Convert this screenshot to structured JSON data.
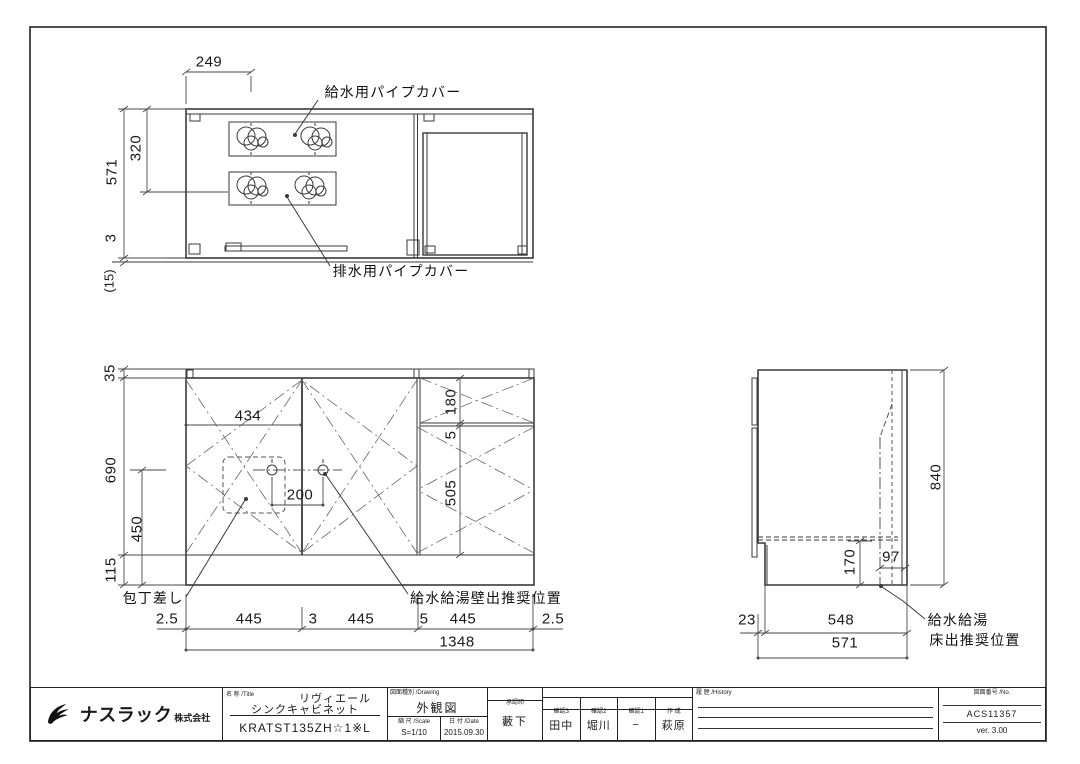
{
  "colors": {
    "line": "#3a3a3a",
    "dim": "#4a4a4a",
    "text": "#1a1a1a",
    "background": "#ffffff"
  },
  "plan_view": {
    "label_supply_pipe_cover": "給水用パイプカバー",
    "label_drain_pipe_cover": "排水用パイプカバー",
    "dim_top_width": "249",
    "dim_depth_total": "571",
    "dim_depth_inner": "320",
    "dim_back_gap": "3",
    "dim_wall_gap": "(15)"
  },
  "front_view": {
    "label_knife_holder": "包丁差し",
    "label_wall_outlet": "給水給湯壁出推奨位置",
    "dim_counter_height": "35",
    "dim_body_height": "690",
    "dim_inner_height": "450",
    "dim_toe_height": "115",
    "dim_left_span": "434",
    "dim_faucet_span": "200",
    "dim_drawer_height": "180",
    "dim_gap": "5",
    "dim_door_height": "505",
    "dim_bottom_row": [
      "2.5",
      "445",
      "3",
      "445",
      "5",
      "445",
      "2.5"
    ],
    "dim_total_width": "1348"
  },
  "side_view": {
    "label_floor_outlet_line1": "給水給湯",
    "label_floor_outlet_line2": "床出推奨位置",
    "dim_total_height": "840",
    "dim_bottom_space": "170",
    "dim_pipe_offset": "97",
    "dim_toe_inset": "23",
    "dim_depth_inner": "548",
    "dim_depth_total": "571"
  },
  "title_block": {
    "company": {
      "name": "ナスラック",
      "suffix": "株式会社"
    },
    "title_cell": {
      "header": "名 称 /Title",
      "product_line1": "リヴィエール",
      "product_line2": "シンクキャビネット",
      "model": "KRATST135ZH☆1※L"
    },
    "drawing_cell": {
      "header": "図面種別 /Drawing",
      "type": "外観図",
      "scale_header": "縮 尺 /Scale",
      "scale": "S=1/10",
      "date_header": "日 付 /Date",
      "date": "2015.09.30"
    },
    "approver_cell": {
      "header": "承認印",
      "name": "藪下"
    },
    "checkup_cell": {
      "header": "照合者 /Check up by ナスラック総合工場",
      "columns": [
        {
          "label": "確認3",
          "value": "田中"
        },
        {
          "label": "確認2",
          "value": "堀川"
        },
        {
          "label": "確認1",
          "value": "−"
        },
        {
          "label": "作 成",
          "value": "萩原"
        }
      ]
    },
    "history_cell": {
      "header": "履 歴 /History"
    },
    "number_cell": {
      "header": "図面番号 /No.",
      "drawing_no": "ACS11357",
      "version": "ver. 3.00"
    }
  }
}
